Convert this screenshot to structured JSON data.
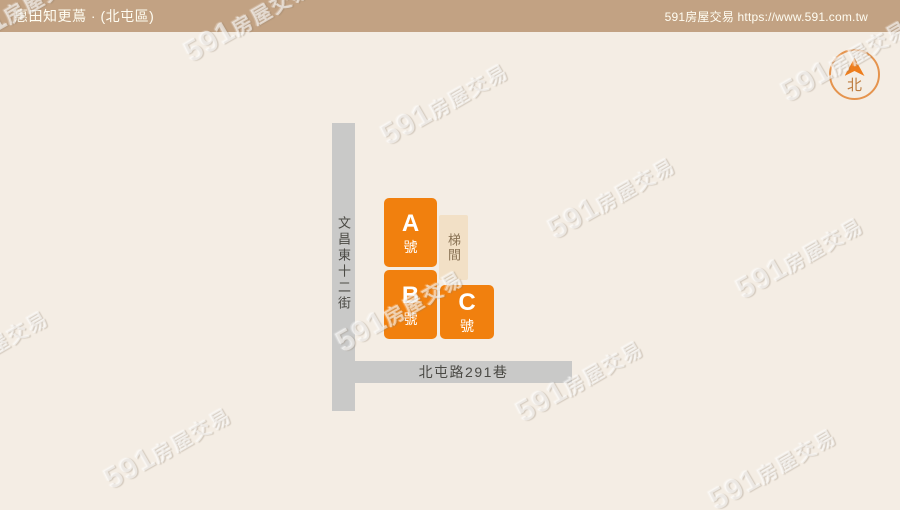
{
  "header": {
    "title": "惠田知更蔦 · (北屯區)",
    "site": "591房屋交易 https://www.591.com.tw"
  },
  "compass": {
    "north_label": "北"
  },
  "map": {
    "vertical_road_name": "文昌東十二街",
    "horizontal_road_name": "北屯路291巷",
    "buildings": [
      {
        "letter": "A",
        "unit": "號"
      },
      {
        "letter": "B",
        "unit": "號"
      },
      {
        "letter": "C",
        "unit": "號"
      }
    ],
    "stairwell_label": "梯間"
  },
  "watermark": {
    "digits": "591",
    "cjk": "房屋交易"
  },
  "colors": {
    "header-bg": "#c2a283",
    "header-text": "#fffdf2",
    "canvas-bg": "#f4ede4",
    "road": "#c9c9c8",
    "road-text": "#4b4a45",
    "building-orange": "#f1800e",
    "building-text": "#ffffff",
    "stair-bg": "#f2e0c6",
    "stair-text": "#8a7355",
    "compass-ring": "#e5944e",
    "compass-arrow": "#ee7d1c",
    "compass-text": "#bd7c3f"
  }
}
